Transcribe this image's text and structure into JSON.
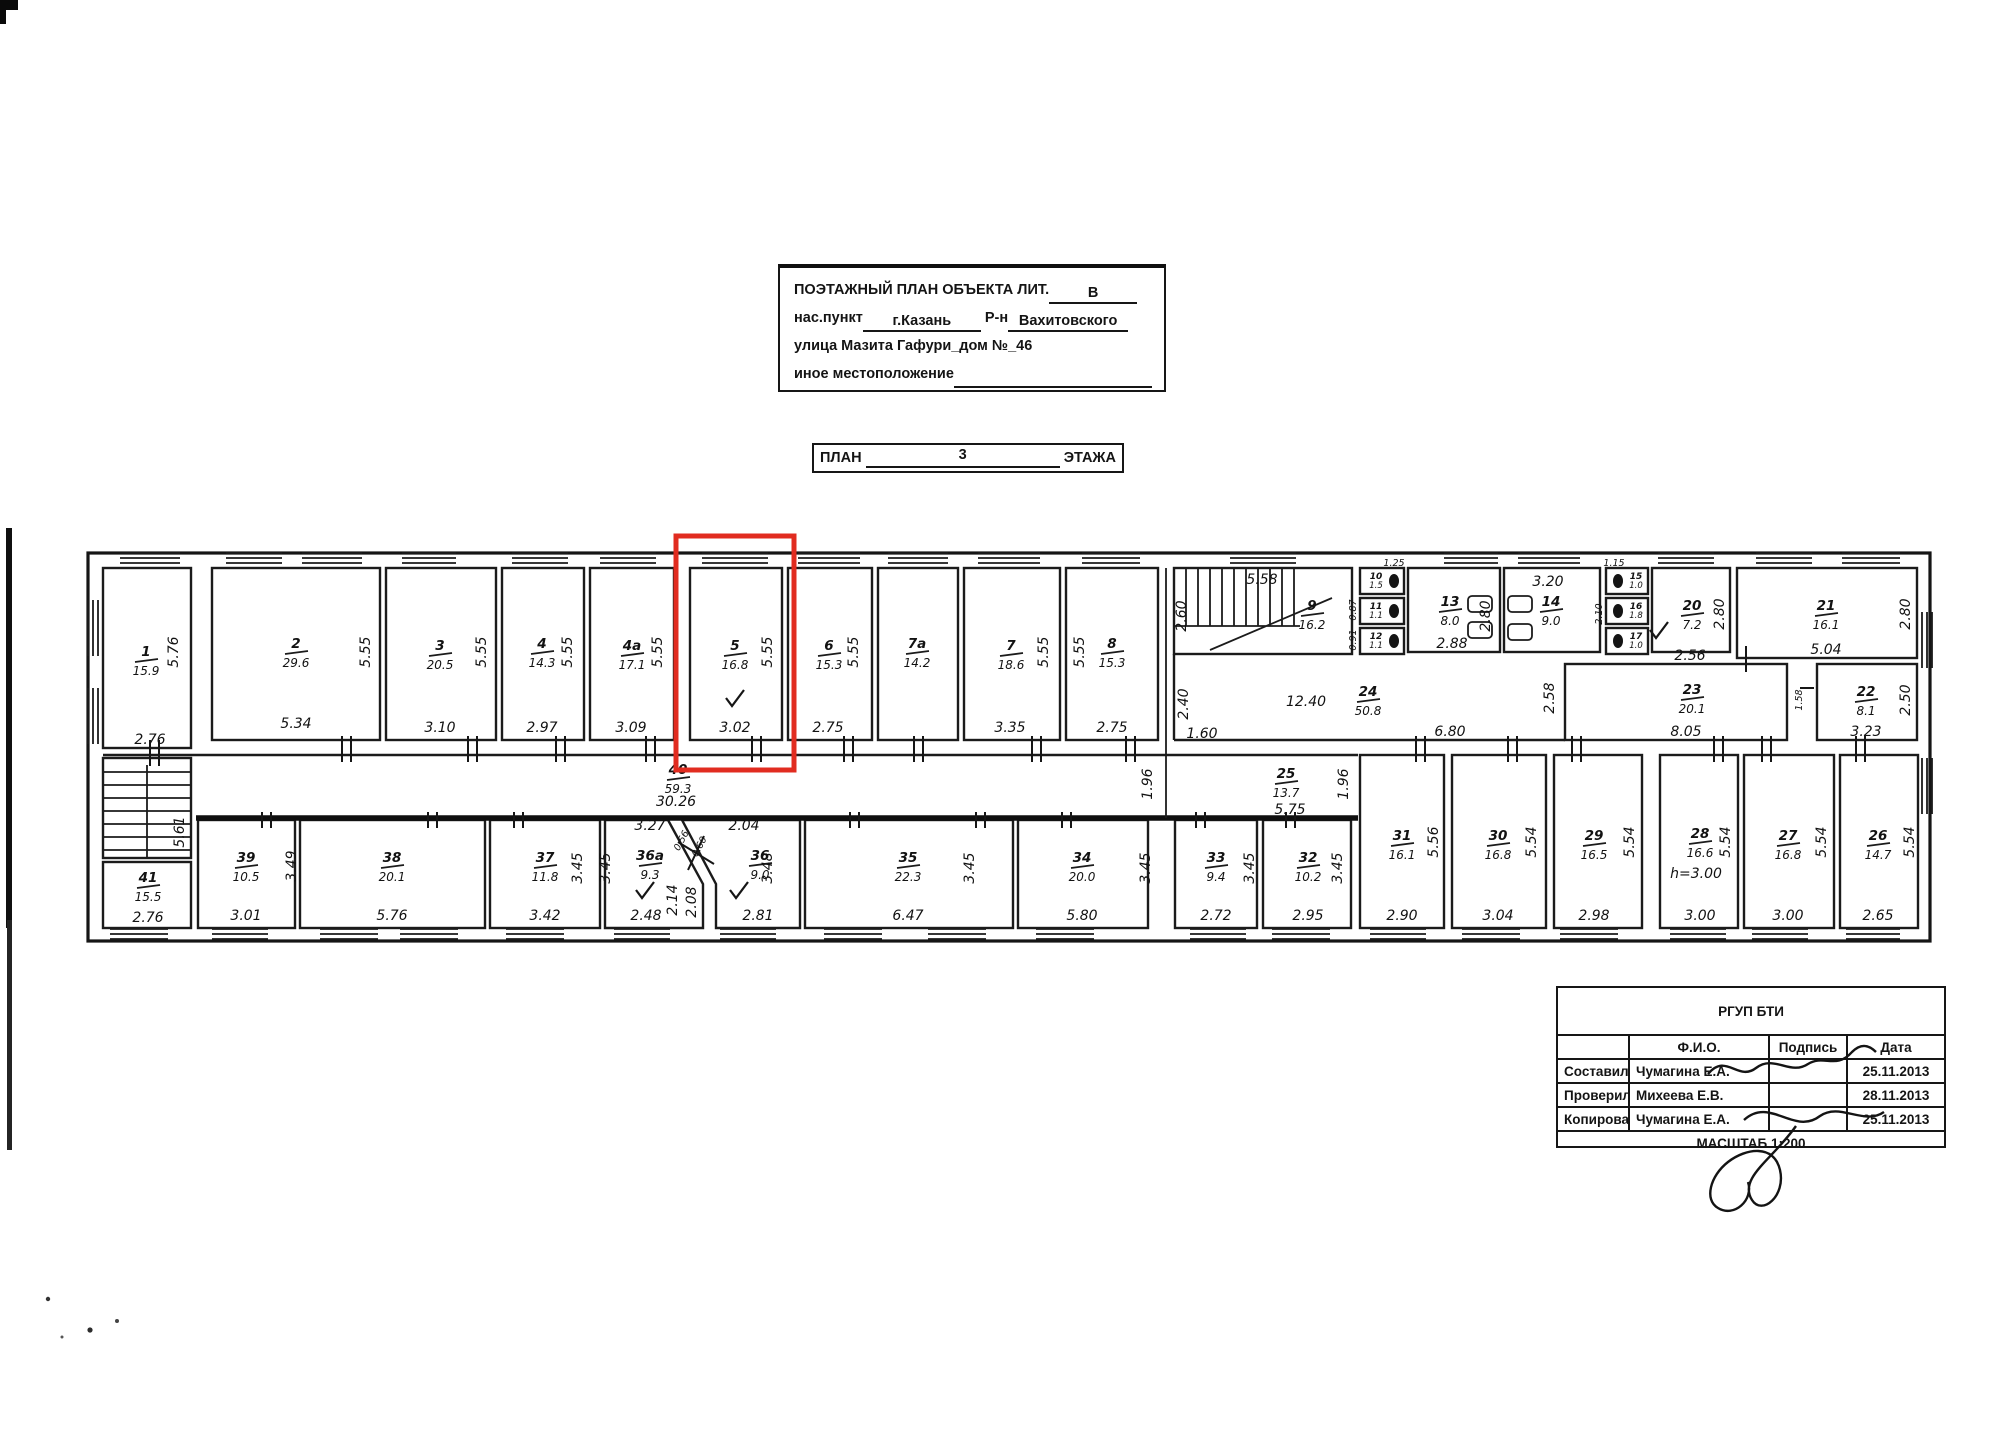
{
  "title_block": {
    "title": "ПОЭТАЖНЫЙ ПЛАН ОБЪЕКТА ЛИТ.",
    "lit": "В",
    "settlement_label": "нас.пункт",
    "settlement": "г.Казань",
    "district_label": "Р-н",
    "district": "Вахитовского",
    "street": "улица Мазита Гафури_дом №_46",
    "other_label": "иное местоположение"
  },
  "caption": {
    "plan": "ПЛАН",
    "floor": "3",
    "floor_label": "ЭТАЖА"
  },
  "stamp": {
    "org": "РГУП БТИ",
    "col_fio": "Ф.И.О.",
    "col_sign": "Подпись",
    "col_date": "Дата",
    "rows": [
      {
        "role": "Составил",
        "fio": "Чумагина Е.А.",
        "date": "25.11.2013"
      },
      {
        "role": "Проверил",
        "fio": "Михеева Е.В.",
        "date": "28.11.2013"
      },
      {
        "role": "Копировал",
        "fio": "Чумагина Е.А.",
        "date": "25.11.2013"
      }
    ],
    "scale": "МАСШТАБ 1:200"
  },
  "colors": {
    "highlight": "#e12c20",
    "ink": "#1b1b1b"
  },
  "plan": {
    "rooms": {
      "r1": {
        "n": "1",
        "a": "15.9"
      },
      "r2": {
        "n": "2",
        "a": "29.6"
      },
      "r3": {
        "n": "3",
        "a": "20.5"
      },
      "r4": {
        "n": "4",
        "a": "14.3"
      },
      "r4a": {
        "n": "4а",
        "a": "17.1"
      },
      "r5": {
        "n": "5",
        "a": "16.8"
      },
      "r6": {
        "n": "6",
        "a": "15.3"
      },
      "r7a": {
        "n": "7а",
        "a": "14.2"
      },
      "r7": {
        "n": "7",
        "a": "18.6"
      },
      "r8": {
        "n": "8",
        "a": "15.3"
      },
      "r9": {
        "n": "9",
        "a": "16.2"
      },
      "r10": {
        "n": "10",
        "a": "1.5"
      },
      "r11": {
        "n": "11",
        "a": "1.1"
      },
      "r12": {
        "n": "12",
        "a": "1.1"
      },
      "r13": {
        "n": "13",
        "a": "8.0"
      },
      "r14": {
        "n": "14",
        "a": "9.0"
      },
      "r15": {
        "n": "15",
        "a": "1.0"
      },
      "r16": {
        "n": "16",
        "a": "1.8"
      },
      "r17": {
        "n": "17",
        "a": "1.0"
      },
      "r20": {
        "n": "20",
        "a": "7.2"
      },
      "r21": {
        "n": "21",
        "a": "16.1"
      },
      "r22": {
        "n": "22",
        "a": "8.1"
      },
      "r23": {
        "n": "23",
        "a": "20.1"
      },
      "r24": {
        "n": "24",
        "a": "50.8"
      },
      "r25": {
        "n": "25",
        "a": "13.7"
      },
      "r26": {
        "n": "26",
        "a": "14.7"
      },
      "r27": {
        "n": "27",
        "a": "16.8"
      },
      "r28": {
        "n": "28",
        "a": "16.6"
      },
      "r29": {
        "n": "29",
        "a": "16.5"
      },
      "r30": {
        "n": "30",
        "a": "16.8"
      },
      "r31": {
        "n": "31",
        "a": "16.1"
      },
      "r32": {
        "n": "32",
        "a": "10.2"
      },
      "r33": {
        "n": "33",
        "a": "9.4"
      },
      "r34": {
        "n": "34",
        "a": "20.0"
      },
      "r35": {
        "n": "35",
        "a": "22.3"
      },
      "r36": {
        "n": "36",
        "a": "9.0"
      },
      "r36a": {
        "n": "36а",
        "a": "9.3"
      },
      "r37": {
        "n": "37",
        "a": "11.8"
      },
      "r38": {
        "n": "38",
        "a": "20.1"
      },
      "r39": {
        "n": "39",
        "a": "10.5"
      },
      "r40": {
        "n": "40",
        "a": "59.3"
      },
      "r41": {
        "n": "41",
        "a": "15.5"
      }
    },
    "d": {
      "d555": "5.55",
      "d576": "5.76",
      "d534": "5.34",
      "d310": "3.10",
      "d297": "2.97",
      "d309": "3.09",
      "d302": "3.02",
      "d275": "2.75",
      "d335": "3.35",
      "d558": "5.58",
      "d260": "2.60",
      "d288": "2.88",
      "d280": "2.80",
      "d320": "3.20",
      "d256": "2.56",
      "d504": "5.04",
      "d323": "3.23",
      "d250": "2.50",
      "d805": "8.05",
      "d680": "6.80",
      "d1240": "12.40",
      "d240": "2.40",
      "d160": "1.60",
      "d258": "2.58",
      "d575": "5.75",
      "d196": "1.96",
      "d3026": "30.26",
      "d327": "3.27",
      "d056": "0.56",
      "d060": "0.60",
      "d204": "2.04",
      "d214": "2.14",
      "d208": "2.08",
      "d276": "2.76",
      "d301": "3.01",
      "d349": "3.49",
      "d342": "3.42",
      "d345": "3.45",
      "d348": "3.48",
      "d248": "2.48",
      "d281": "2.81",
      "d647": "6.47",
      "d580": "5.80",
      "d272": "2.72",
      "d295": "2.95",
      "d290": "2.90",
      "d304": "3.04",
      "d298": "2.98",
      "d300": "3.00",
      "d265": "2.65",
      "d556": "5.56",
      "d554": "5.54",
      "dh300": "h=3.00",
      "d561": "5.61",
      "d125": "1.25",
      "d087": "0.87",
      "d091": "0.91",
      "d115": "1.15",
      "d210": "2.10",
      "d158": "1.58"
    }
  }
}
